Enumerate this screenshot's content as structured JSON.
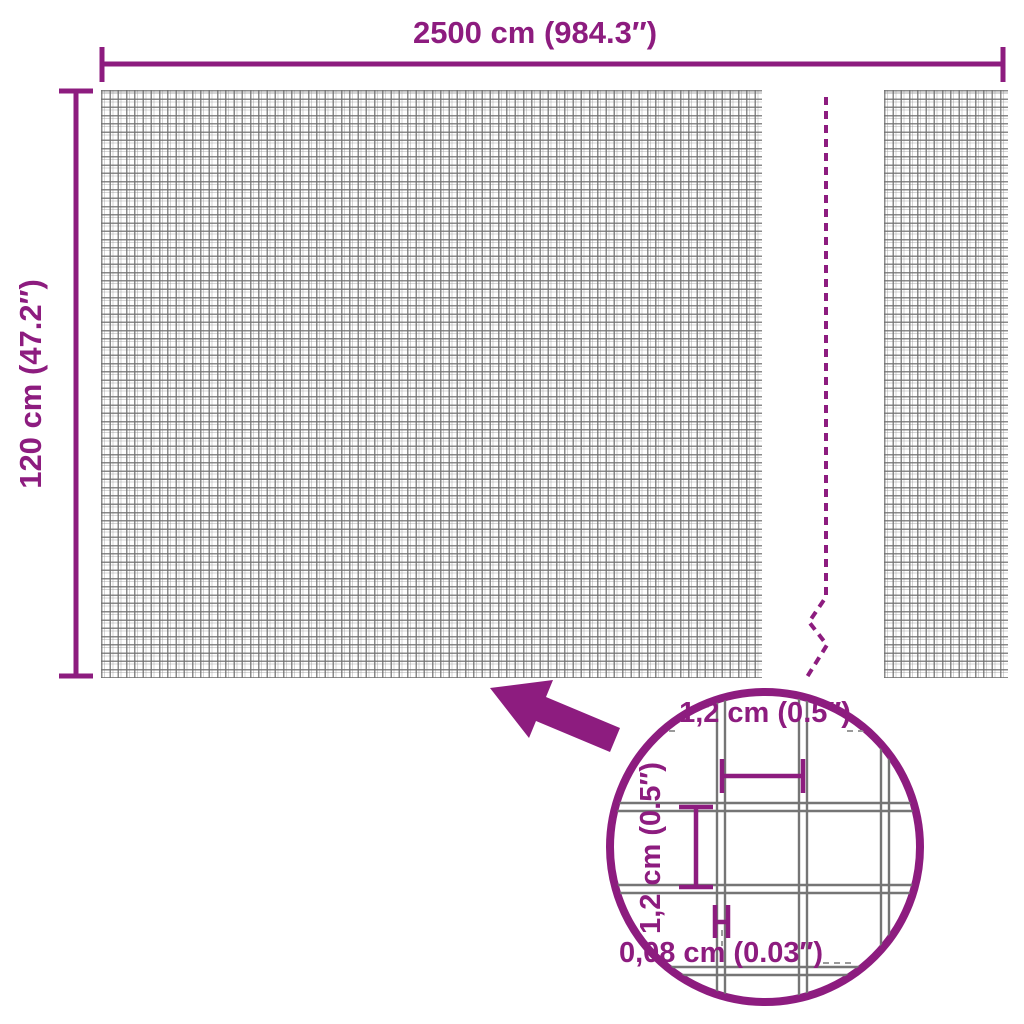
{
  "colors": {
    "accent": "#8d1c7f",
    "mesh_line": "#8a8a8a",
    "detail_wire": "#757575",
    "leader": "#9a9a9a",
    "background": "#ffffff"
  },
  "overall_dimensions": {
    "width_label": "2500 cm (984.3″)",
    "height_label": "120 cm (47.2″)"
  },
  "detail_dimensions": {
    "cell_width_label": "1,2 cm (0.5″)",
    "cell_height_label": "1,2 cm (0.5″)",
    "wire_thickness_label": "0,08 cm (0.03″)"
  }
}
